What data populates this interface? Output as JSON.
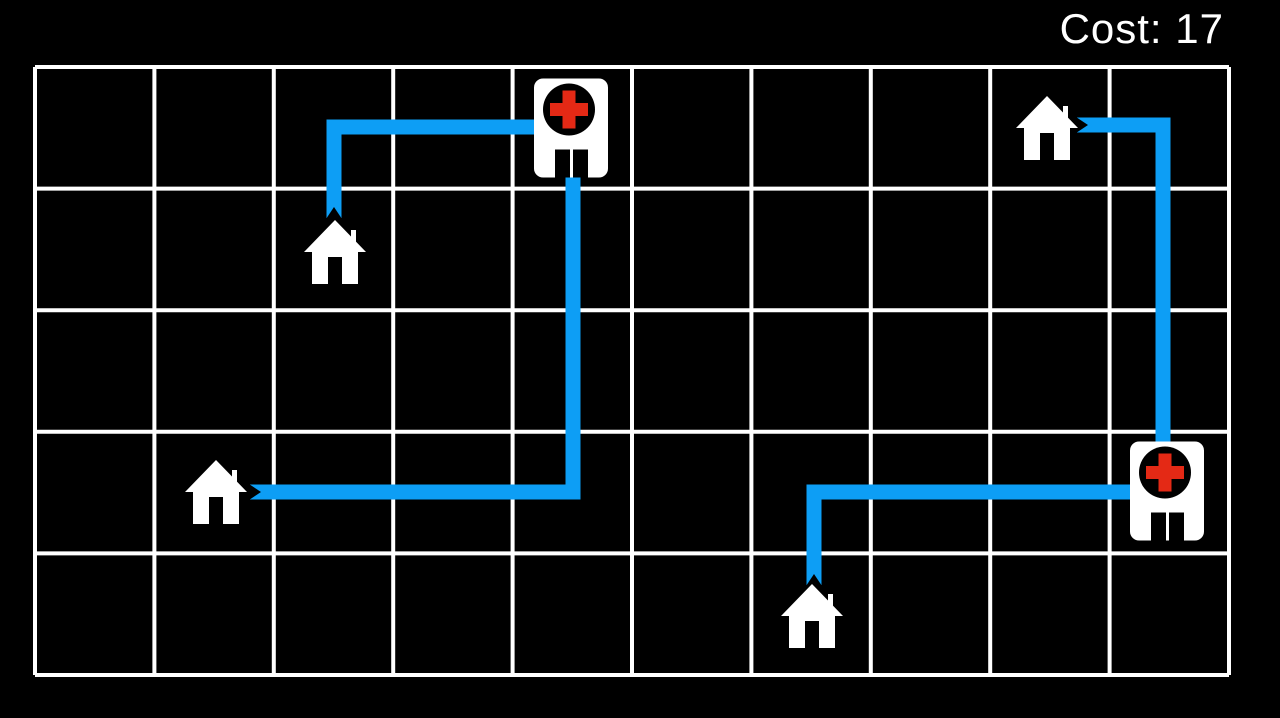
{
  "hud": {
    "cost_label": "Cost:",
    "cost_value": "17",
    "cost_text": "Cost: 17"
  },
  "colors": {
    "background": "#000000",
    "grid_line": "#ffffff",
    "route_blue": "#0d9ef5",
    "building_white": "#ffffff",
    "cross_red": "#e42915",
    "detail_black": "#000000"
  },
  "board": {
    "grid": {
      "cols": 10,
      "rows": 5,
      "left": 35,
      "top": 67,
      "right": 1229,
      "bottom": 675,
      "line_width": 4
    },
    "houses": [
      {
        "id": "house-1",
        "col": 2,
        "row": 1,
        "cx": 335,
        "cy": 252
      },
      {
        "id": "house-2",
        "col": 1,
        "row": 3,
        "cx": 216,
        "cy": 492
      },
      {
        "id": "house-3",
        "col": 8,
        "row": 0,
        "cx": 1047,
        "cy": 128
      },
      {
        "id": "house-4",
        "col": 6,
        "row": 4,
        "cx": 812,
        "cy": 616
      }
    ],
    "hospitals": [
      {
        "id": "hospital-1",
        "col": 4,
        "row": 0,
        "cx": 571,
        "cy": 128
      },
      {
        "id": "hospital-2",
        "col": 9,
        "row": 3,
        "cx": 1167,
        "cy": 491
      }
    ],
    "routes": [
      {
        "id": "route-1",
        "from": "house-1",
        "to": "hospital-1",
        "points": [
          [
            334,
            218
          ],
          [
            334,
            127
          ],
          [
            540,
            127
          ]
        ],
        "notch": {
          "x": 334,
          "y": 218,
          "dir": "up"
        }
      },
      {
        "id": "route-2",
        "from": "house-2",
        "to": "hospital-1",
        "points": [
          [
            250,
            492
          ],
          [
            573,
            492
          ],
          [
            573,
            170
          ]
        ],
        "notch": {
          "x": 250,
          "y": 492,
          "dir": "right"
        }
      },
      {
        "id": "route-3",
        "from": "house-3",
        "to": "hospital-2",
        "points": [
          [
            1077,
            125
          ],
          [
            1163,
            125
          ],
          [
            1163,
            448
          ]
        ],
        "notch": {
          "x": 1077,
          "y": 125,
          "dir": "right"
        }
      },
      {
        "id": "route-4",
        "from": "house-4",
        "to": "hospital-2",
        "points": [
          [
            814,
            585
          ],
          [
            814,
            492
          ],
          [
            1140,
            492
          ]
        ],
        "notch": {
          "x": 814,
          "y": 585,
          "dir": "up"
        }
      }
    ]
  },
  "sizes": {
    "house_w": 62,
    "house_h": 64,
    "hospital_w": 74,
    "hospital_h": 99,
    "route_width": 15
  }
}
